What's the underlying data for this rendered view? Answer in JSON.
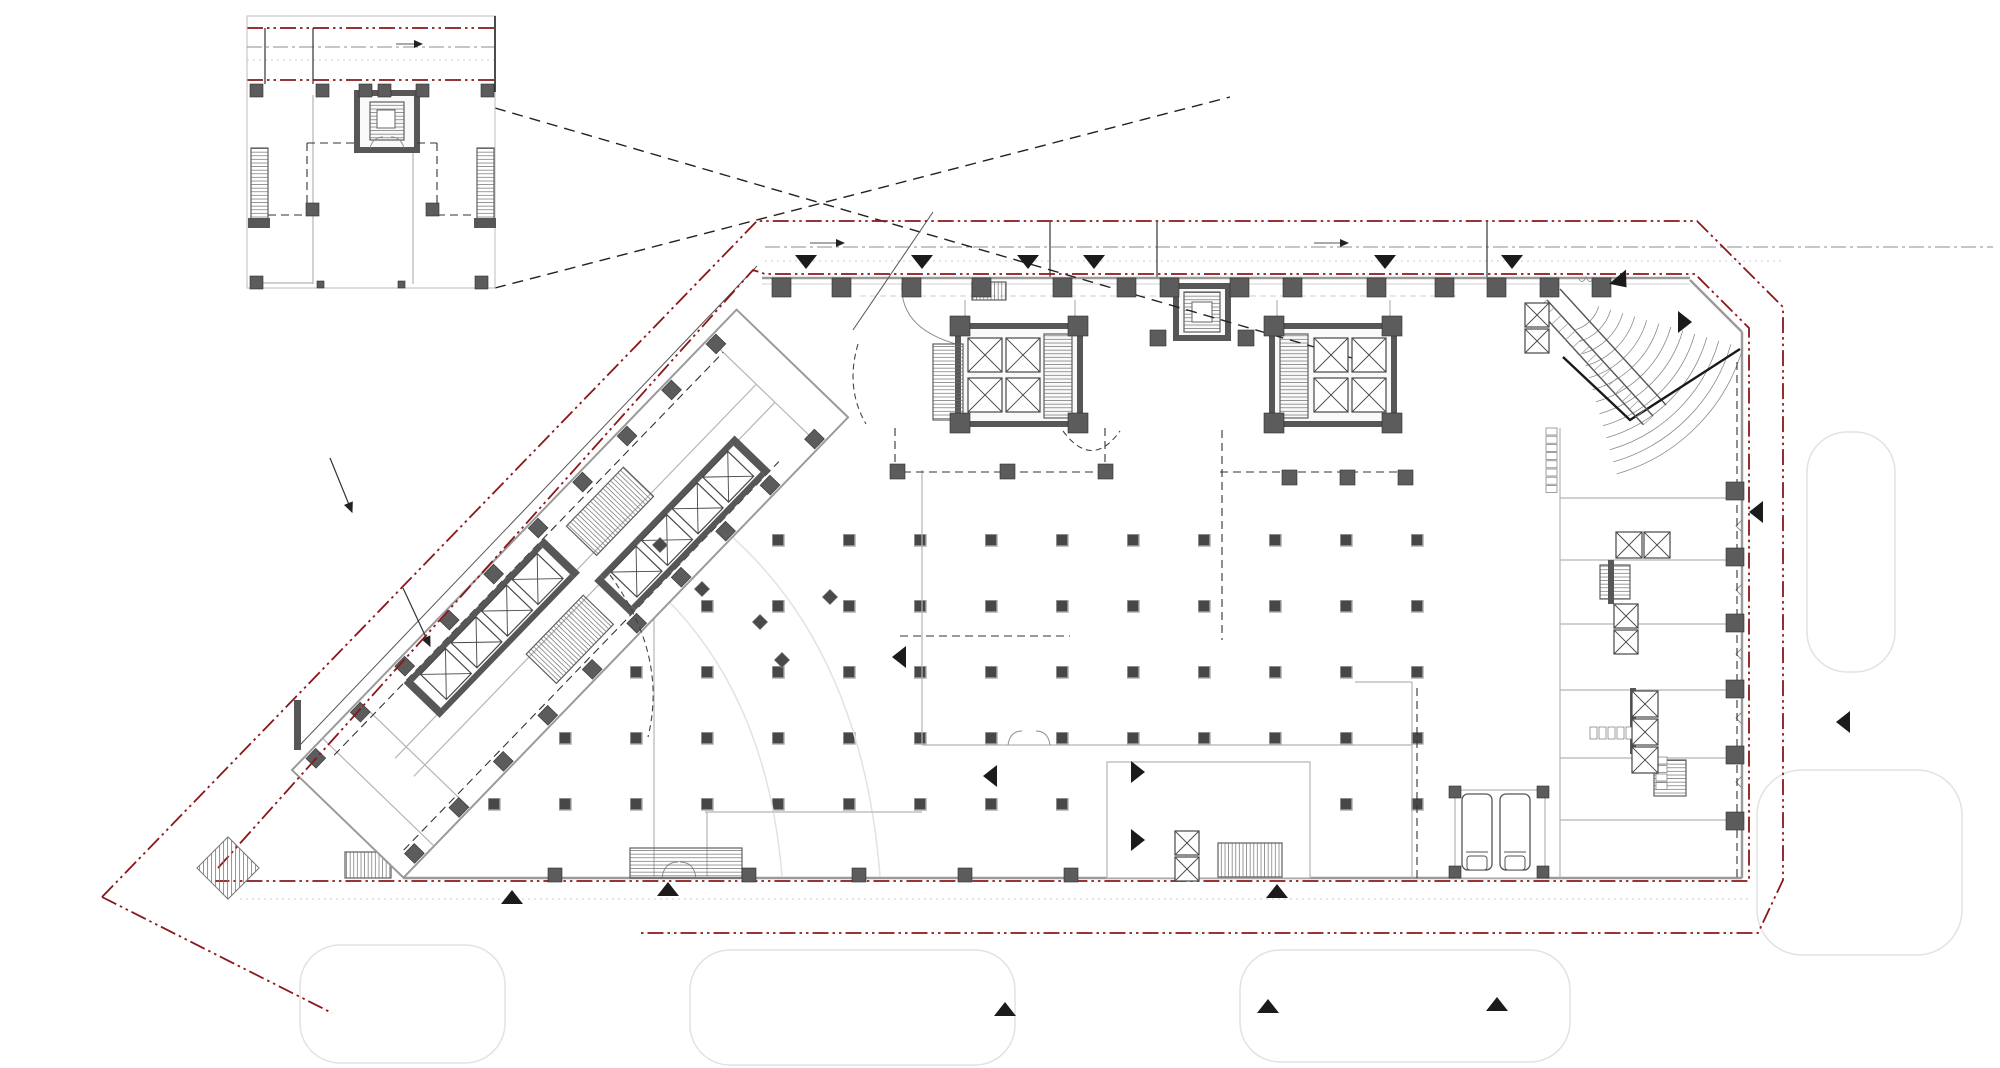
{
  "document": {
    "description": "Architectural ground-floor plan drawing with site boundary, enlarged detail inset, tower cores, diagonal wing, column grid and entrance markers",
    "visible_text": ""
  },
  "colors": {
    "paper": "#ffffff",
    "boundary_red": "#8a1719",
    "marker_black": "#1b1b1b",
    "core_dark": "#575757",
    "column_dark": "#5c5c5c",
    "wall_gray": "#9a9a9a",
    "road_gray": "#8c8c8c"
  },
  "markers": {
    "triangles": [
      {
        "x": 806,
        "y": 262,
        "a": 0
      },
      {
        "x": 922,
        "y": 262,
        "a": 0
      },
      {
        "x": 1028,
        "y": 262,
        "a": 0
      },
      {
        "x": 1094,
        "y": 262,
        "a": 0
      },
      {
        "x": 1385,
        "y": 262,
        "a": 0
      },
      {
        "x": 1512,
        "y": 262,
        "a": 0
      },
      {
        "x": 1622,
        "y": 282,
        "a": -40
      },
      {
        "x": 1685,
        "y": 322,
        "a": -90
      },
      {
        "x": 1756,
        "y": 512,
        "a": 90
      },
      {
        "x": 1843,
        "y": 722,
        "a": 90
      },
      {
        "x": 512,
        "y": 897,
        "a": 180
      },
      {
        "x": 668,
        "y": 889,
        "a": 180
      },
      {
        "x": 1277,
        "y": 891,
        "a": 180
      },
      {
        "x": 1005,
        "y": 1009,
        "a": 180
      },
      {
        "x": 1268,
        "y": 1006,
        "a": 180
      },
      {
        "x": 1497,
        "y": 1004,
        "a": 180
      },
      {
        "x": 1138,
        "y": 772,
        "a": -90
      },
      {
        "x": 1138,
        "y": 840,
        "a": -90
      },
      {
        "x": 990,
        "y": 776,
        "a": 90
      },
      {
        "x": 899,
        "y": 657,
        "a": 90
      }
    ]
  },
  "columns": [
    {
      "x": 772,
      "y": 278,
      "s": 19
    },
    {
      "x": 832,
      "y": 278,
      "s": 19
    },
    {
      "x": 902,
      "y": 278,
      "s": 19
    },
    {
      "x": 972,
      "y": 278,
      "s": 19
    },
    {
      "x": 1053,
      "y": 278,
      "s": 19
    },
    {
      "x": 1117,
      "y": 278,
      "s": 19
    },
    {
      "x": 1160,
      "y": 278,
      "s": 19
    },
    {
      "x": 1230,
      "y": 278,
      "s": 19
    },
    {
      "x": 1283,
      "y": 278,
      "s": 19
    },
    {
      "x": 1367,
      "y": 278,
      "s": 19
    },
    {
      "x": 1435,
      "y": 278,
      "s": 19
    },
    {
      "x": 1487,
      "y": 278,
      "s": 19
    },
    {
      "x": 1540,
      "y": 278,
      "s": 19
    },
    {
      "x": 1592,
      "y": 278,
      "s": 19
    },
    {
      "x": 950,
      "y": 316,
      "s": 20
    },
    {
      "x": 1068,
      "y": 316,
      "s": 20
    },
    {
      "x": 950,
      "y": 413,
      "s": 20
    },
    {
      "x": 1068,
      "y": 413,
      "s": 20
    },
    {
      "x": 1264,
      "y": 316,
      "s": 20
    },
    {
      "x": 1382,
      "y": 316,
      "s": 20
    },
    {
      "x": 1264,
      "y": 413,
      "s": 20
    },
    {
      "x": 1382,
      "y": 413,
      "s": 20
    },
    {
      "x": 1150,
      "y": 330,
      "s": 16
    },
    {
      "x": 1238,
      "y": 330,
      "s": 16
    },
    {
      "x": 890,
      "y": 464,
      "s": 15
    },
    {
      "x": 1000,
      "y": 464,
      "s": 15
    },
    {
      "x": 1098,
      "y": 464,
      "s": 15
    },
    {
      "x": 1282,
      "y": 470,
      "s": 15
    },
    {
      "x": 1340,
      "y": 470,
      "s": 15
    },
    {
      "x": 1398,
      "y": 470,
      "s": 15
    },
    {
      "x": 1726,
      "y": 482,
      "s": 18
    },
    {
      "x": 1726,
      "y": 548,
      "s": 18
    },
    {
      "x": 1726,
      "y": 614,
      "s": 18
    },
    {
      "x": 1726,
      "y": 680,
      "s": 18
    },
    {
      "x": 1726,
      "y": 746,
      "s": 18
    },
    {
      "x": 1726,
      "y": 812,
      "s": 18
    },
    {
      "x": 548,
      "y": 868,
      "s": 14
    },
    {
      "x": 742,
      "y": 868,
      "s": 14
    },
    {
      "x": 852,
      "y": 868,
      "s": 14
    },
    {
      "x": 958,
      "y": 868,
      "s": 14
    },
    {
      "x": 1064,
      "y": 868,
      "s": 14
    },
    {
      "x": 1449,
      "y": 786,
      "s": 12
    },
    {
      "x": 1537,
      "y": 786,
      "s": 12
    },
    {
      "x": 1449,
      "y": 866,
      "s": 12
    },
    {
      "x": 1537,
      "y": 866,
      "s": 12
    },
    {
      "x": 250,
      "y": 84,
      "s": 13
    },
    {
      "x": 316,
      "y": 84,
      "s": 13
    },
    {
      "x": 359,
      "y": 84,
      "s": 13
    },
    {
      "x": 378,
      "y": 84,
      "s": 13
    },
    {
      "x": 416,
      "y": 84,
      "s": 13
    },
    {
      "x": 481,
      "y": 84,
      "s": 13
    },
    {
      "x": 306,
      "y": 203,
      "s": 13
    },
    {
      "x": 426,
      "y": 203,
      "s": 13
    },
    {
      "x": 250,
      "y": 276,
      "s": 13
    },
    {
      "x": 475,
      "y": 276,
      "s": 13
    },
    {
      "x": 317,
      "y": 281,
      "s": 7
    },
    {
      "x": 398,
      "y": 281,
      "s": 7
    },
    {
      "x": 18,
      "y": 2,
      "s": 14,
      "g": "wing"
    },
    {
      "x": 82,
      "y": 2,
      "s": 14,
      "g": "wing"
    },
    {
      "x": 146,
      "y": 2,
      "s": 14,
      "g": "wing"
    },
    {
      "x": 210,
      "y": 2,
      "s": 14,
      "g": "wing"
    },
    {
      "x": 274,
      "y": 2,
      "s": 14,
      "g": "wing"
    },
    {
      "x": 338,
      "y": 2,
      "s": 14,
      "g": "wing"
    },
    {
      "x": 402,
      "y": 2,
      "s": 14,
      "g": "wing"
    },
    {
      "x": 466,
      "y": 2,
      "s": 14,
      "g": "wing"
    },
    {
      "x": 530,
      "y": 2,
      "s": 14,
      "g": "wing"
    },
    {
      "x": 594,
      "y": 2,
      "s": 14,
      "g": "wing"
    },
    {
      "x": 18,
      "y": 139,
      "s": 14,
      "g": "wing"
    },
    {
      "x": 82,
      "y": 139,
      "s": 14,
      "g": "wing"
    },
    {
      "x": 146,
      "y": 139,
      "s": 14,
      "g": "wing"
    },
    {
      "x": 210,
      "y": 139,
      "s": 14,
      "g": "wing"
    },
    {
      "x": 274,
      "y": 139,
      "s": 14,
      "g": "wing"
    },
    {
      "x": 338,
      "y": 139,
      "s": 14,
      "g": "wing"
    },
    {
      "x": 402,
      "y": 139,
      "s": 14,
      "g": "wing"
    },
    {
      "x": 466,
      "y": 139,
      "s": 14,
      "g": "wing"
    },
    {
      "x": 530,
      "y": 139,
      "s": 14,
      "g": "wing"
    },
    {
      "x": 594,
      "y": 139,
      "s": 14,
      "g": "wing"
    }
  ],
  "elevators": [
    {
      "x": 968,
      "y": 338,
      "s": 34
    },
    {
      "x": 1006,
      "y": 338,
      "s": 34
    },
    {
      "x": 968,
      "y": 378,
      "s": 34
    },
    {
      "x": 1006,
      "y": 378,
      "s": 34
    },
    {
      "x": 1314,
      "y": 338,
      "s": 34
    },
    {
      "x": 1352,
      "y": 338,
      "s": 34
    },
    {
      "x": 1314,
      "y": 378,
      "s": 34
    },
    {
      "x": 1352,
      "y": 378,
      "s": 34
    },
    {
      "x": 1525,
      "y": 303,
      "s": 24
    },
    {
      "x": 1525,
      "y": 329,
      "s": 24
    },
    {
      "x": 1616,
      "y": 532,
      "s": 26
    },
    {
      "x": 1644,
      "y": 532,
      "s": 26
    },
    {
      "x": 1614,
      "y": 604,
      "s": 24
    },
    {
      "x": 1614,
      "y": 630,
      "s": 24
    },
    {
      "x": 1632,
      "y": 691,
      "s": 26
    },
    {
      "x": 1632,
      "y": 719,
      "s": 26
    },
    {
      "x": 1632,
      "y": 747,
      "s": 26
    },
    {
      "x": 1175,
      "y": 831,
      "s": 24
    },
    {
      "x": 1175,
      "y": 857,
      "s": 24
    }
  ],
  "fixtures": [
    {
      "x": 1546,
      "y": 428,
      "w": 11,
      "h": 7,
      "n": 8,
      "dx": 0,
      "dy": 8.2
    },
    {
      "x": 1590,
      "y": 727,
      "w": 7,
      "h": 12,
      "n": 5,
      "dx": 9,
      "dy": 0
    },
    {
      "x": 1656,
      "y": 757,
      "w": 11,
      "h": 7,
      "n": 4,
      "dx": 0,
      "dy": 8.5
    }
  ],
  "diamonds": [
    {
      "x": 660,
      "y": 545
    },
    {
      "x": 702,
      "y": 589
    },
    {
      "x": 760,
      "y": 622
    },
    {
      "x": 830,
      "y": 597
    },
    {
      "x": 782,
      "y": 660
    }
  ],
  "fan": {
    "cx": 1566,
    "cy": 297,
    "r0": 34,
    "r1": 184,
    "n": 13,
    "a0": 16,
    "a1": 74
  },
  "escalator": {
    "x1": 1547,
    "y1": 300,
    "x2": 1653,
    "y2": 416,
    "off": 13,
    "n": 15
  }
}
